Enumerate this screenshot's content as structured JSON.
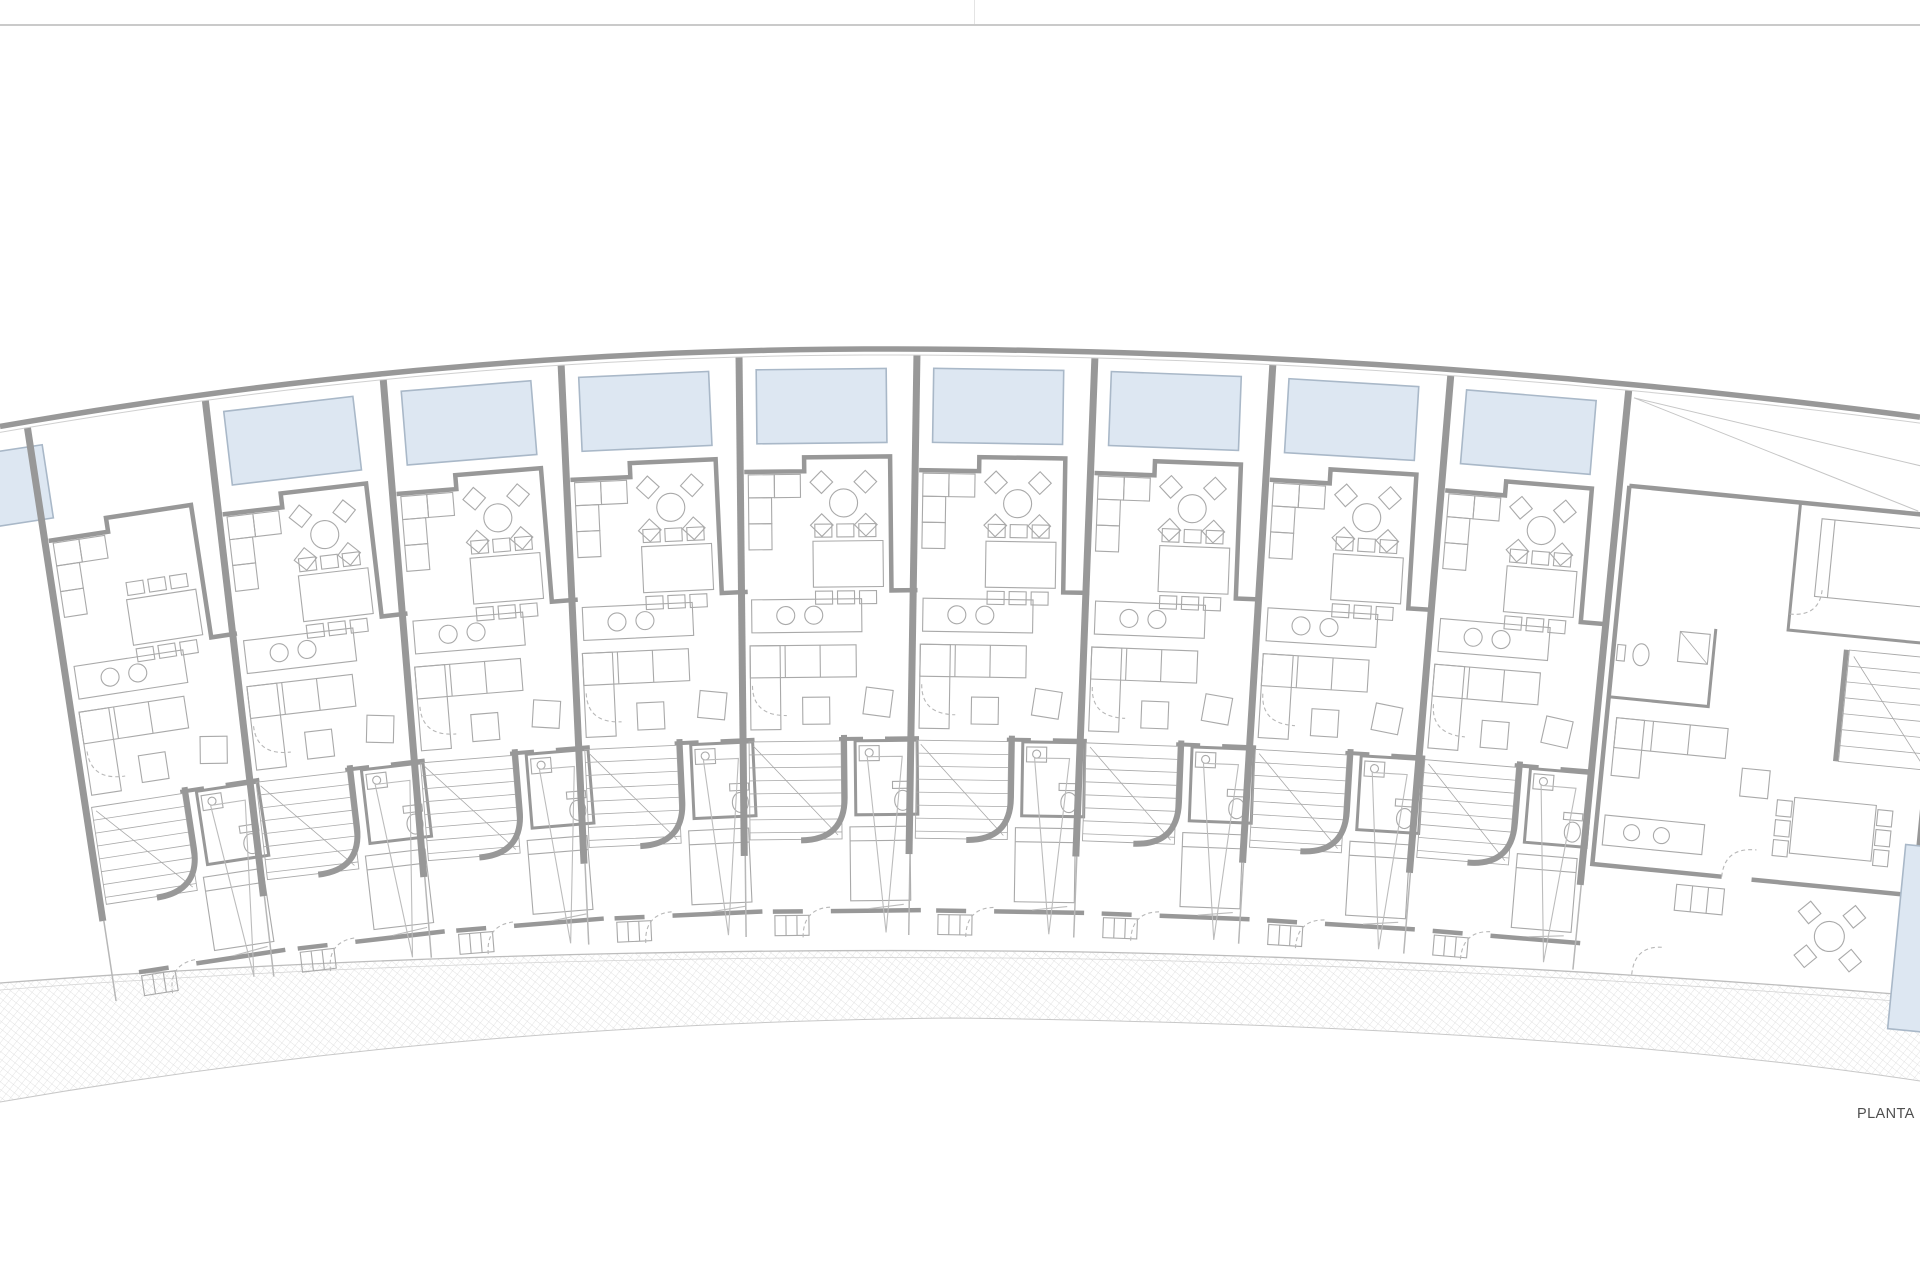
{
  "plan": {
    "caption": "PLANTA",
    "row_houses": 9,
    "corner_houses": 1,
    "pools": 10,
    "colors": {
      "wall": "#989898",
      "wall_light": "#b7b7b7",
      "furniture": "#a9a9a9",
      "pool_fill": "#dde7f2",
      "pool_border": "#a9b8c8",
      "paving_hatch": "#d9d9d9",
      "paving_edge": "#bdbdbd",
      "paving_inner": "#d4d4d4",
      "garden_line": "#c6c6c6",
      "caption_text": "#4f4f4f",
      "top_rule": "#cacaca",
      "page_divider": "#e4e4e4"
    }
  }
}
